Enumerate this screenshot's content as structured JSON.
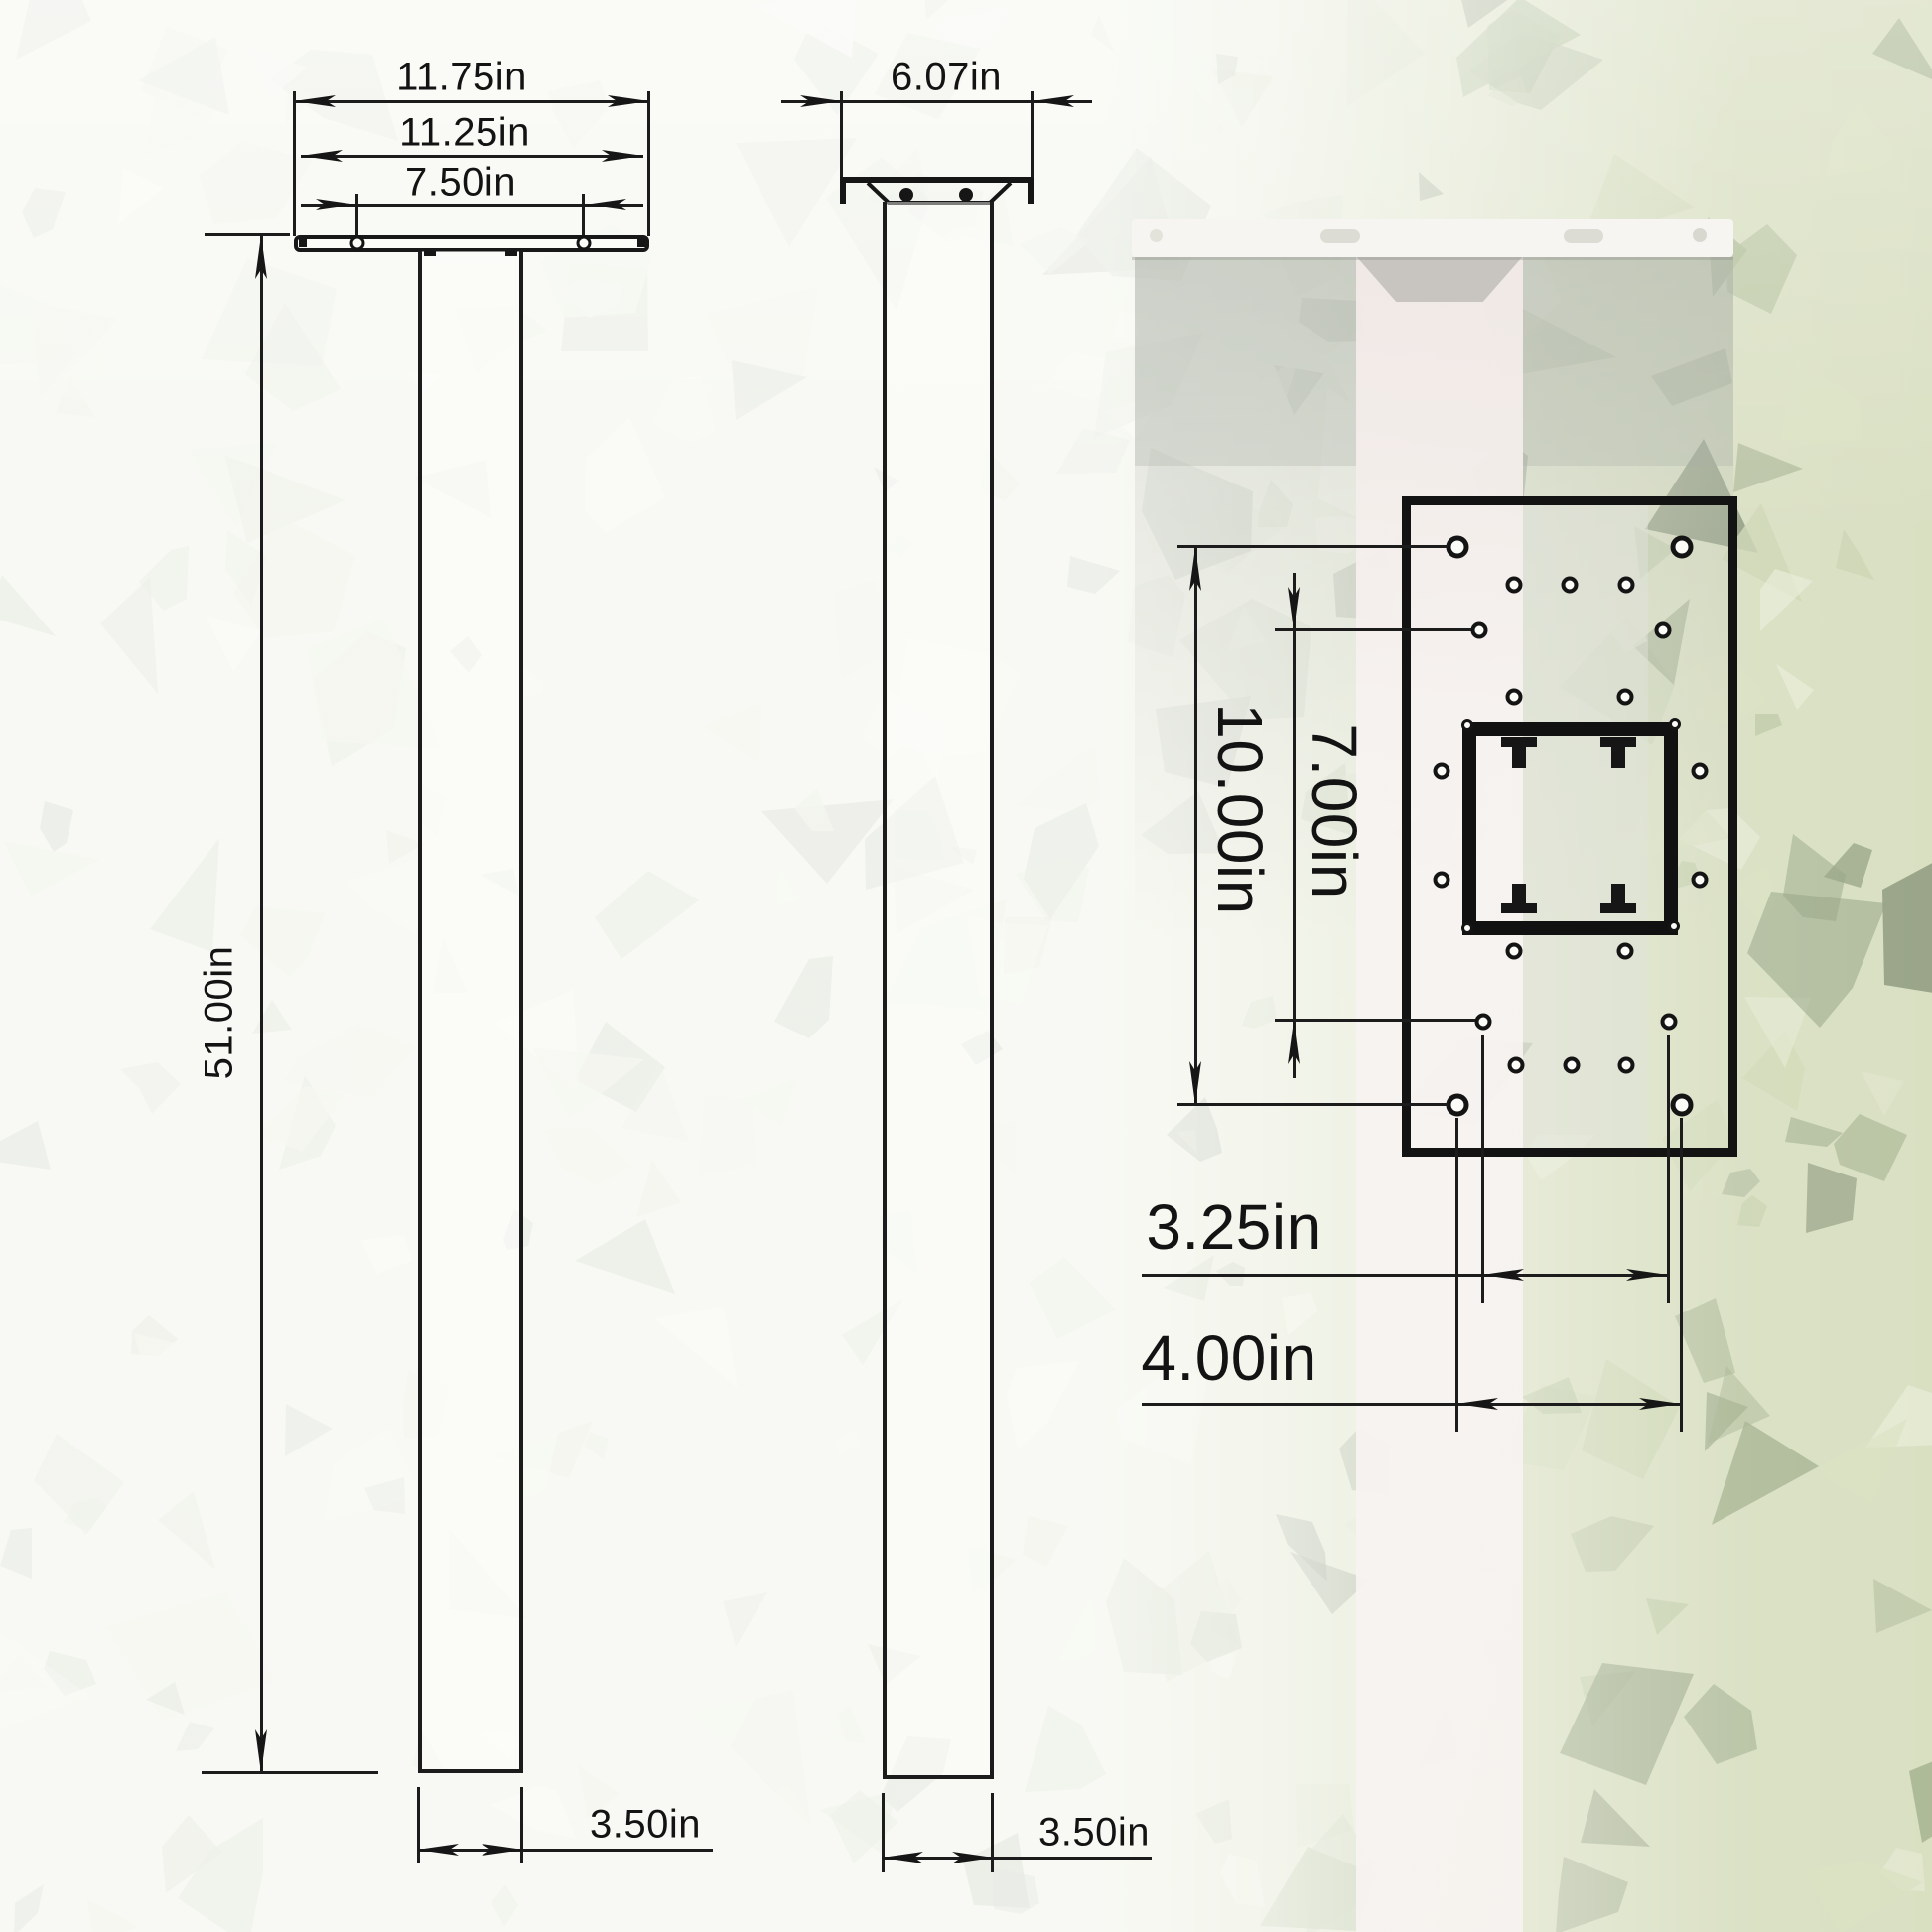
{
  "diagram": {
    "kind": "technical dimension drawing, 3 views of a square mounting post",
    "front_view": {
      "outer_width": "11.75in",
      "plate_width": "11.25in",
      "bolt_hole_span": "7.50in",
      "post_height": "51.00in",
      "post_width": "3.50in"
    },
    "side_view": {
      "plate_width": "6.07in",
      "post_width": "3.50in"
    },
    "plate_view": {
      "outer_hole_height": "10.00in",
      "inner_hole_height": "7.00in",
      "hole_span_narrow": "3.25in",
      "hole_span_wide": "4.00in"
    },
    "colors": {
      "line": "#1c1c1c",
      "leaf_base": "#c9d2a8",
      "veil": "#ffffff",
      "photo_post": "#f6f2f0"
    }
  }
}
